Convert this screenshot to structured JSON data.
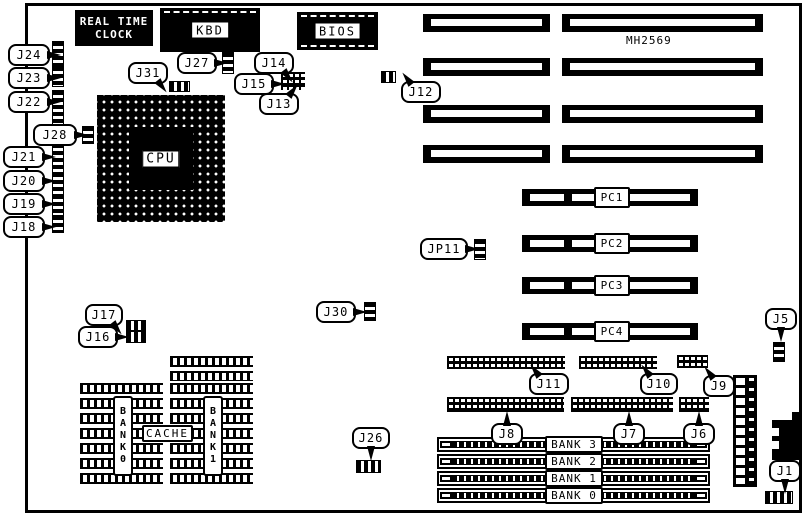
{
  "board": {
    "silkscreen": "MH2569",
    "rtc_line1": "REAL TIME",
    "rtc_line2": "CLOCK",
    "kbd": "KBD",
    "bios": "BIOS",
    "cpu": "CPU",
    "tag": "TAG",
    "cache": "CACHE",
    "cache_bank0": "BANK0",
    "cache_bank1": "BANK1",
    "pci_slots": [
      "PC1",
      "PC2",
      "PC3",
      "PC4"
    ],
    "simm_banks": [
      "BANK 3",
      "BANK 2",
      "BANK 1",
      "BANK 0"
    ],
    "colors": {
      "ink": "#000000",
      "paper": "#ffffff"
    },
    "callouts": [
      {
        "label": "J24",
        "x": 8,
        "y": 44,
        "w": 38,
        "dir": "right",
        "conn": {
          "x": 52,
          "y": 41,
          "w": 10,
          "h": 27,
          "t": "v"
        }
      },
      {
        "label": "J23",
        "x": 8,
        "y": 67,
        "w": 38,
        "dir": "right",
        "conn": {
          "x": 52,
          "y": 66,
          "w": 10,
          "h": 19,
          "t": "v"
        }
      },
      {
        "label": "J22",
        "x": 8,
        "y": 91,
        "w": 38,
        "dir": "right",
        "conn": {
          "x": 52,
          "y": 90,
          "w": 10,
          "h": 33,
          "t": "v"
        }
      },
      {
        "label": "J28",
        "x": 33,
        "y": 124,
        "w": 40,
        "dir": "right",
        "conn": {
          "x": 82,
          "y": 126,
          "w": 10,
          "h": 16,
          "t": "v"
        }
      },
      {
        "label": "J21",
        "x": 3,
        "y": 146,
        "w": 38,
        "dir": "right",
        "conn": {
          "x": 52,
          "y": 143,
          "w": 10,
          "h": 32,
          "t": "v"
        }
      },
      {
        "label": "J20",
        "x": 3,
        "y": 170,
        "w": 38,
        "dir": "right",
        "conn": {
          "x": 52,
          "y": 172,
          "w": 10,
          "h": 21,
          "t": "v"
        }
      },
      {
        "label": "J19",
        "x": 3,
        "y": 193,
        "w": 38,
        "dir": "right",
        "conn": {
          "x": 52,
          "y": 194,
          "w": 10,
          "h": 20,
          "t": "v"
        }
      },
      {
        "label": "J18",
        "x": 3,
        "y": 216,
        "w": 38,
        "dir": "right",
        "conn": {
          "x": 52,
          "y": 215,
          "w": 10,
          "h": 16,
          "t": "v"
        }
      },
      {
        "label": "J31",
        "x": 128,
        "y": 62,
        "w": 36,
        "dir": "down-right",
        "conn": {
          "x": 169,
          "y": 81,
          "w": 19,
          "h": 9,
          "t": "h"
        }
      },
      {
        "label": "J27",
        "x": 177,
        "y": 52,
        "w": 36,
        "dir": "right",
        "conn": {
          "x": 222,
          "y": 52,
          "w": 10,
          "h": 20,
          "t": "v"
        }
      },
      {
        "label": "J14",
        "x": 254,
        "y": 52,
        "w": 36,
        "dir": "down-right",
        "conn": null
      },
      {
        "label": "J15",
        "x": 234,
        "y": 73,
        "w": 36,
        "dir": "right",
        "conn": {
          "x": 281,
          "y": 72,
          "w": 24,
          "h": 18,
          "t": "g"
        }
      },
      {
        "label": "J13",
        "x": 259,
        "y": 93,
        "w": 36,
        "dir": "up-right",
        "conn": null
      },
      {
        "label": "J12",
        "x": 401,
        "y": 81,
        "w": 36,
        "dir": "up-left",
        "conn": {
          "x": 381,
          "y": 71,
          "w": 13,
          "h": 10,
          "t": "h"
        }
      },
      {
        "label": "JP11",
        "x": 420,
        "y": 238,
        "w": 44,
        "dir": "right",
        "conn": {
          "x": 474,
          "y": 239,
          "w": 10,
          "h": 19,
          "t": "v"
        }
      },
      {
        "label": "J30",
        "x": 316,
        "y": 301,
        "w": 36,
        "dir": "right",
        "conn": {
          "x": 364,
          "y": 302,
          "w": 10,
          "h": 17,
          "t": "v"
        }
      },
      {
        "label": "J17",
        "x": 85,
        "y": 304,
        "w": 34,
        "dir": "down-right",
        "conn": {
          "x": 126,
          "y": 320,
          "w": 18,
          "h": 9,
          "t": "h"
        }
      },
      {
        "label": "J16",
        "x": 78,
        "y": 326,
        "w": 36,
        "dir": "right",
        "conn": {
          "x": 126,
          "y": 331,
          "w": 18,
          "h": 10,
          "t": "h"
        }
      },
      {
        "label": "J11",
        "x": 529,
        "y": 373,
        "w": 36,
        "dir": "up-left",
        "conn": {
          "x": 447,
          "y": 356,
          "w": 118,
          "h": 13,
          "t": "g"
        }
      },
      {
        "label": "J10",
        "x": 640,
        "y": 373,
        "w": 34,
        "dir": "up-left",
        "conn": {
          "x": 579,
          "y": 356,
          "w": 78,
          "h": 13,
          "t": "g"
        }
      },
      {
        "label": "J9",
        "x": 703,
        "y": 375,
        "w": 28,
        "dir": "up-left",
        "conn": {
          "x": 677,
          "y": 355,
          "w": 31,
          "h": 13,
          "t": "g"
        }
      },
      {
        "label": "J8",
        "x": 491,
        "y": 423,
        "w": 28,
        "dir": "up",
        "conn": {
          "x": 447,
          "y": 397,
          "w": 117,
          "h": 15,
          "t": "g"
        }
      },
      {
        "label": "J7",
        "x": 613,
        "y": 423,
        "w": 28,
        "dir": "up",
        "conn": {
          "x": 571,
          "y": 397,
          "w": 102,
          "h": 15,
          "t": "g"
        }
      },
      {
        "label": "J6",
        "x": 683,
        "y": 423,
        "w": 28,
        "dir": "up",
        "conn": {
          "x": 679,
          "y": 397,
          "w": 30,
          "h": 15,
          "t": "g"
        }
      },
      {
        "label": "J26",
        "x": 352,
        "y": 427,
        "w": 34,
        "dir": "down",
        "conn": {
          "x": 356,
          "y": 460,
          "w": 23,
          "h": 11,
          "t": "h"
        }
      },
      {
        "label": "J5",
        "x": 765,
        "y": 308,
        "w": 28,
        "dir": "down",
        "conn": {
          "x": 773,
          "y": 342,
          "w": 10,
          "h": 18,
          "t": "v"
        }
      },
      {
        "label": "J1",
        "x": 769,
        "y": 460,
        "w": 28,
        "dir": "down",
        "conn": {
          "x": 765,
          "y": 491,
          "w": 26,
          "h": 11,
          "t": "h"
        }
      }
    ]
  }
}
